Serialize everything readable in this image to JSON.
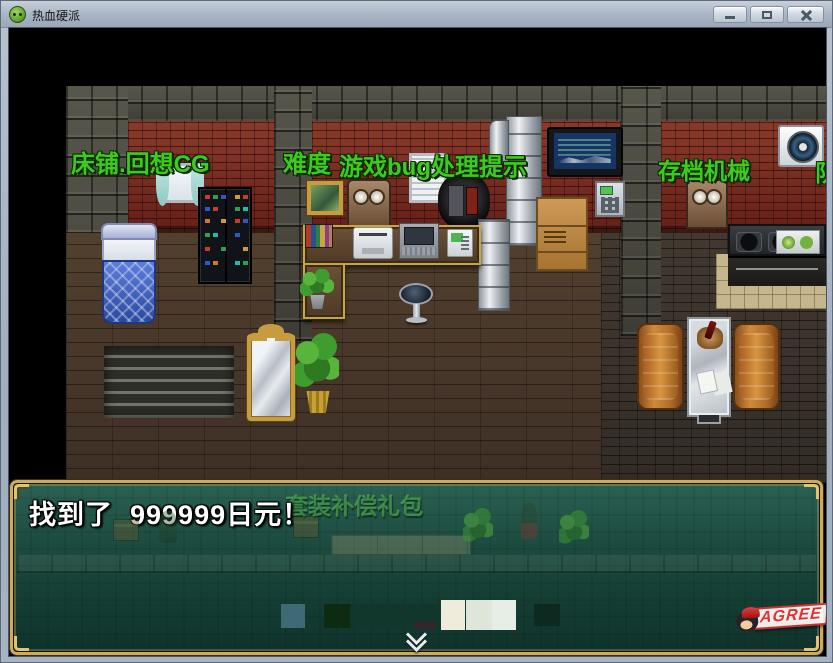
{
  "window": {
    "title": "热血硬派"
  },
  "map_labels": {
    "bed_cg": "床铺.回想CG",
    "difficulty": "难度",
    "bug_tips": "游戏bug处理提示",
    "save_machine": "存档机械",
    "team_clipped": "队"
  },
  "message_box": {
    "text": "找到了  999999日元！",
    "background_label": "套装补偿礼包"
  },
  "watermark": {
    "text": "AGREE"
  },
  "colors": {
    "label_green": "#3ecb1e",
    "gold_border": "#cfa95c",
    "message_bg_dark": "#123c33",
    "message_text": "#ffffff",
    "titlebar": "#aab6c5",
    "brick_red": "#7b2c20",
    "sofa_orange": "#b4702c",
    "bed_blue": "#3f62c8"
  }
}
